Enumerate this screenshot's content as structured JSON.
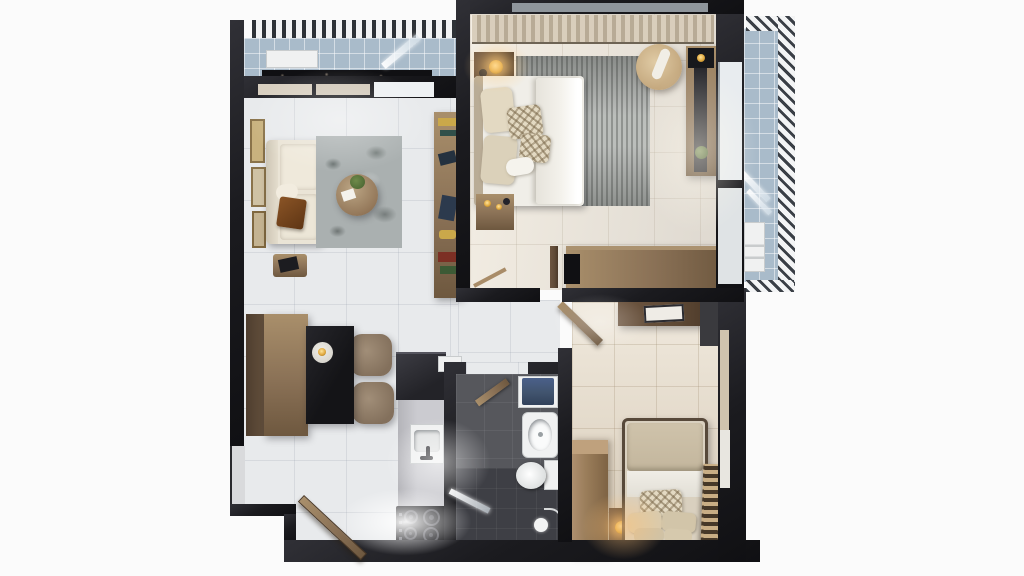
{
  "scene": {
    "description": "Top-down photorealistic 3D render of a one-bedroom apartment floor plan on a plain white background",
    "view": "top-down orthographic 3D floor plan"
  },
  "palette": {
    "bg": "#fbfbfb",
    "wall": "#1b1b1f",
    "wood": "#8a7156",
    "wood_dark": "#5f4a36",
    "wood_light": "#a98f6b",
    "floor_living": "#e8eaec",
    "floor_bedroom_main": "#e9e5de",
    "floor_bedroom_small": "#e3d9c9",
    "floor_bathroom": "#56575c",
    "floor_balcony": "#a9bbca",
    "sofa": "#eae4d6",
    "rug": "#b2b5b2",
    "bed_linen": "#f0eee8",
    "cushion": "#cfc2a9",
    "table_black": "#141417",
    "lamp_gold": "#e0a83e",
    "fixture_white": "#f0f1f1",
    "towel_blue": "#41546e",
    "louver": "#2e3237",
    "glass": "#eef1f3"
  },
  "rooms": [
    {
      "id": "balcony-top",
      "label": "Top balcony with louvered pergola",
      "furniture": [
        "AC unit",
        "stone planter",
        "open glass door"
      ]
    },
    {
      "id": "living-room",
      "label": "Living room",
      "furniture": [
        "cream sofa with brown throw",
        "gallery wall frames",
        "patterned area rug",
        "round coffee table with plant",
        "side stool with tray",
        "media console with decor"
      ]
    },
    {
      "id": "dining-area",
      "label": "Dining area",
      "furniture": [
        "two-tone wooden bench",
        "black dining table with serving plate",
        "two upholstered chairs"
      ]
    },
    {
      "id": "kitchen",
      "label": "Kitchenette",
      "furniture": [
        "tall dark cabinet",
        "counter",
        "sink with faucet",
        "four-burner cooktop"
      ]
    },
    {
      "id": "bathroom",
      "label": "Bathroom",
      "furniture": [
        "vanity with blue towels",
        "pedestal basin",
        "toilet",
        "walk-in shower with glass panel",
        "hand shower",
        "open wooden door"
      ]
    },
    {
      "id": "bedroom-main",
      "label": "Main bedroom",
      "furniture": [
        "double bed with patterned pillows",
        "nightstand with gold lamp",
        "bedside vanity with perfumes",
        "gray area rug",
        "round lounge chair",
        "desk with dark runner and plant",
        "long dresser with TV",
        "curtained window wall"
      ]
    },
    {
      "id": "bedroom-small",
      "label": "Second bedroom",
      "furniture": [
        "wall console with picture frame",
        "wardrobe",
        "nightstand with gold lamp",
        "single bed with pillows",
        "slatted wooden bench",
        "open wooden door"
      ]
    },
    {
      "id": "balcony-right",
      "label": "Right balcony with louver screen",
      "furniture": [
        "AC unit",
        "open glass door"
      ]
    },
    {
      "id": "entry",
      "label": "Entry with open wooden front door",
      "furniture": [
        "entry door"
      ]
    },
    {
      "id": "hallway",
      "label": "Hallway",
      "furniture": []
    }
  ]
}
